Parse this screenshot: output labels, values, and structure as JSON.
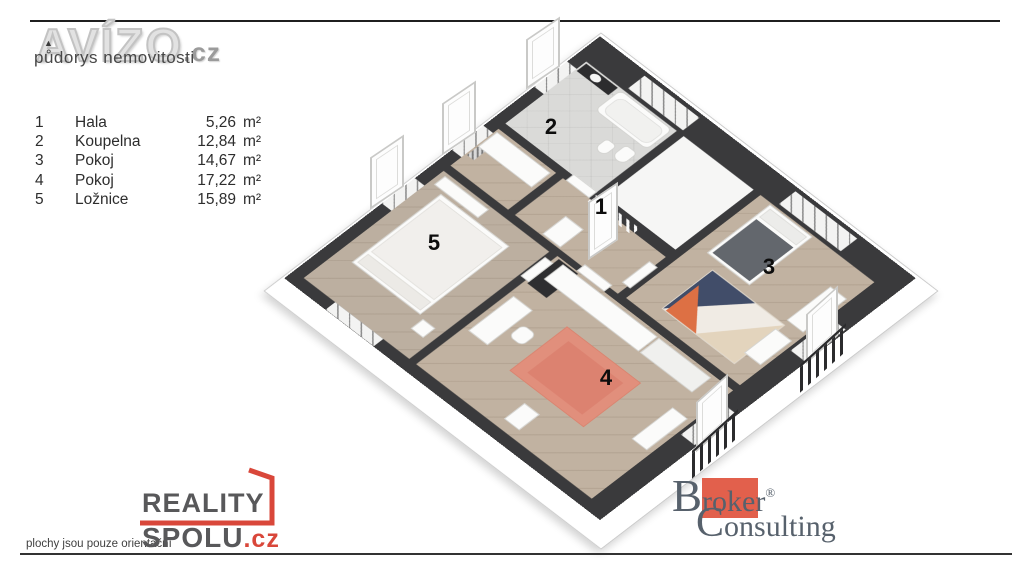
{
  "header": {
    "brand": "AVÍZO",
    "brand_suffix": ".cz",
    "subtitle": "půdorys nemovitosti"
  },
  "legend": {
    "rows": [
      {
        "num": "1",
        "name": "Hala",
        "area": "5,26",
        "unit": "m²"
      },
      {
        "num": "2",
        "name": "Koupelna",
        "area": "12,84",
        "unit": "m²"
      },
      {
        "num": "3",
        "name": "Pokoj",
        "area": "14,67",
        "unit": "m²"
      },
      {
        "num": "4",
        "name": "Pokoj",
        "area": "17,22",
        "unit": "m²"
      },
      {
        "num": "5",
        "name": "Ložnice",
        "area": "15,89",
        "unit": "m²"
      }
    ]
  },
  "plan": {
    "room_labels": [
      "1",
      "2",
      "3",
      "4",
      "5"
    ],
    "rooms": [
      "Hala",
      "Koupelna",
      "Pokoj",
      "Pokoj",
      "Ložnice"
    ]
  },
  "footer": {
    "disclaimer": "plochy jsou pouze orientační",
    "reality": {
      "word1": "REALITY",
      "word2": "SPOLU",
      "tld": ".cz"
    },
    "broker": {
      "cap1": "B",
      "mid1": "rok",
      "end1": "er",
      "reg": "®",
      "cap2": "C",
      "end2": "onsulting"
    }
  },
  "colors": {
    "rule_dark": "#1f1f1f",
    "wall": "#3a3a3c",
    "wood_floor": "#c1b2a1",
    "tile_floor": "#dadad8",
    "accent_red": "#d9473a",
    "broker_red": "#e2604c",
    "rug_salmon": "#e18f7c",
    "rug_navy": "#414d69",
    "rug_orange": "#dd7044",
    "rug_tan": "#e3d4bd",
    "logo_gray": "#e2e2e2"
  }
}
